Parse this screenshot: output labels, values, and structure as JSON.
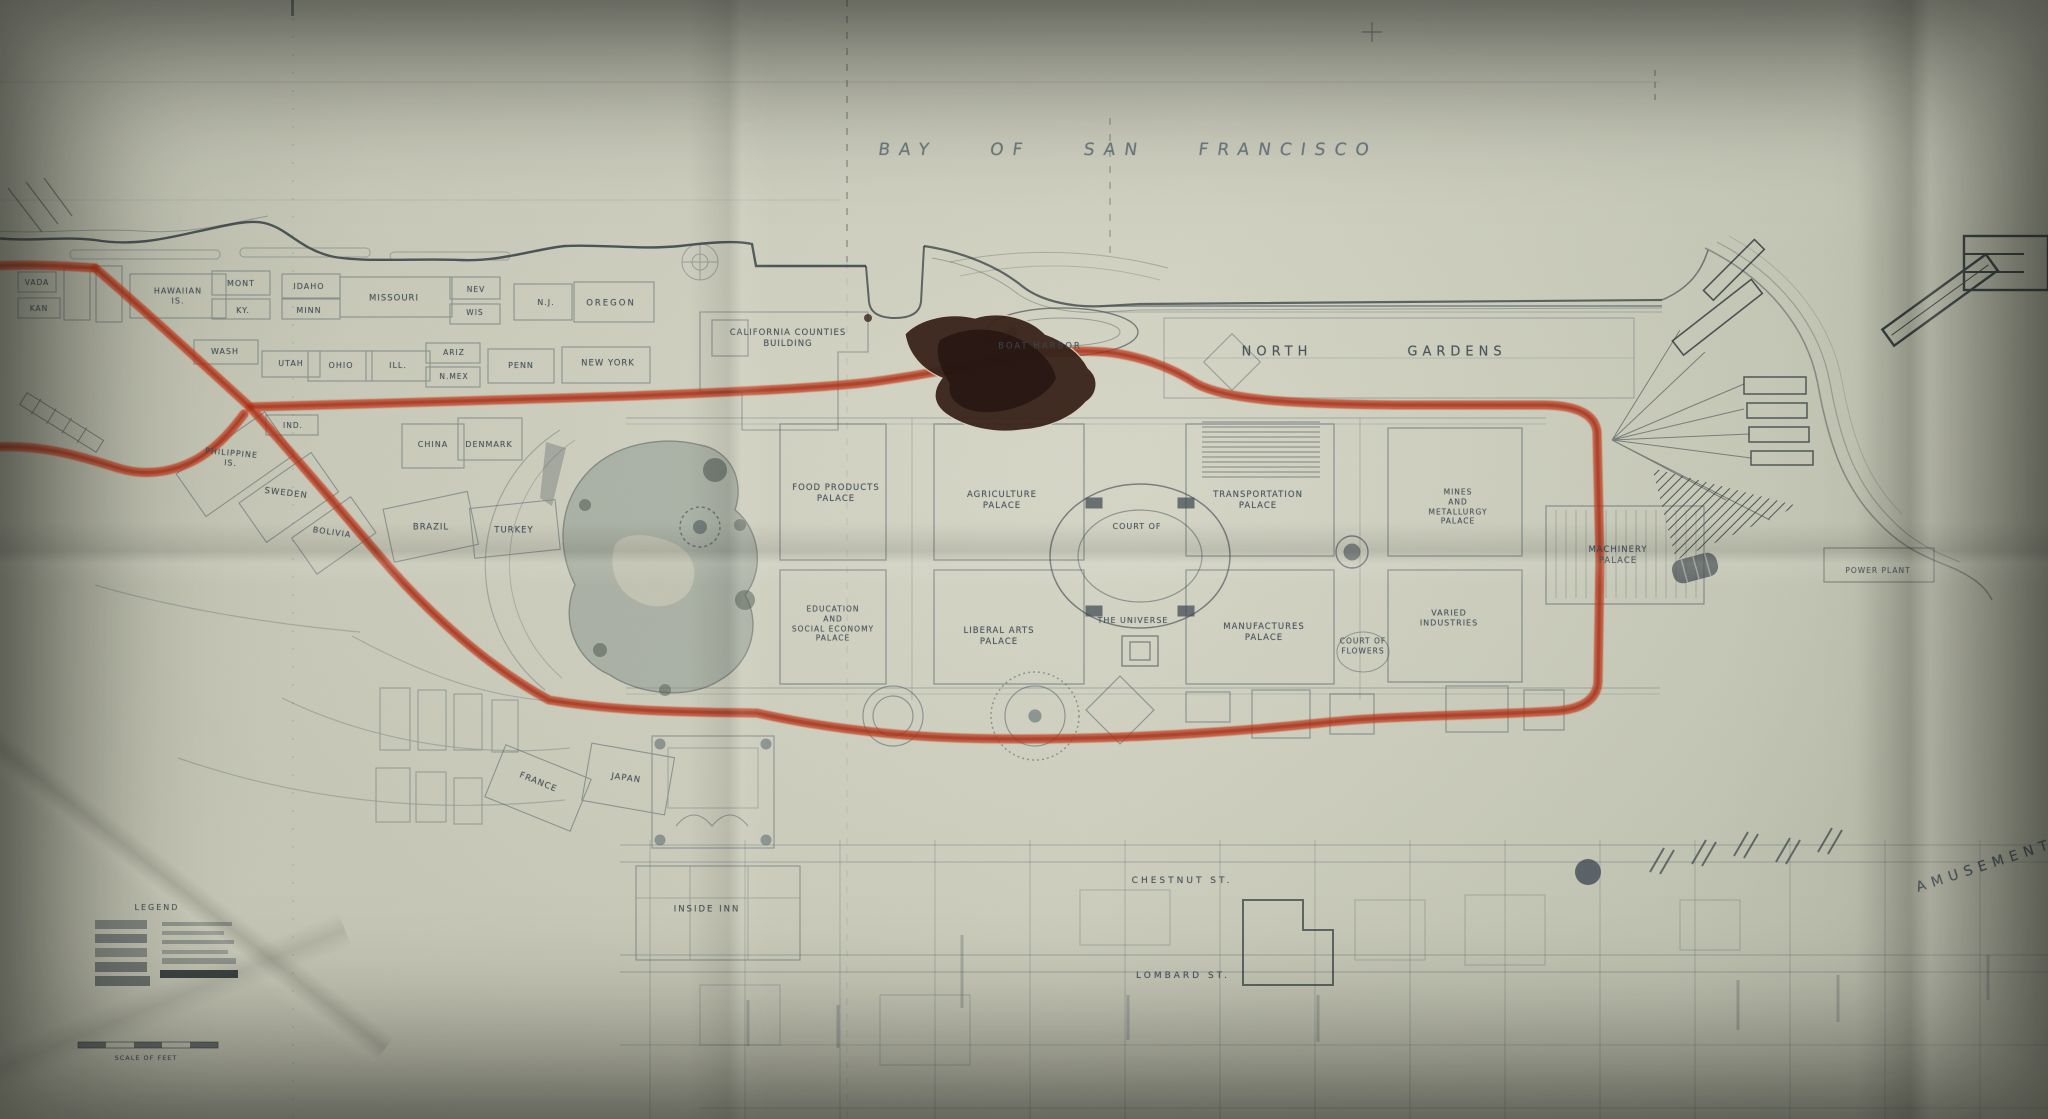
{
  "photo": {
    "bay_label": "BAY OF SAN FRANCISCO",
    "route_color": "#c23a1c",
    "route_core_color": "#8e2810",
    "legend": {
      "title": "LEGEND",
      "scale_label": "SCALE OF FEET"
    },
    "labels": [
      {
        "text": "VADA",
        "x": 37,
        "y": 283,
        "size": 7.5
      },
      {
        "text": "KAN",
        "x": 39,
        "y": 309,
        "size": 7.5
      },
      {
        "text": "HAWAIIAN\nIS.",
        "x": 178,
        "y": 297,
        "size": 8
      },
      {
        "text": "MONT",
        "x": 241,
        "y": 284,
        "size": 8
      },
      {
        "text": "KY.",
        "x": 243,
        "y": 311,
        "size": 8
      },
      {
        "text": "IDAHO",
        "x": 309,
        "y": 287,
        "size": 8
      },
      {
        "text": "MINN",
        "x": 309,
        "y": 311,
        "size": 8
      },
      {
        "text": "MISSOURI",
        "x": 394,
        "y": 299,
        "size": 8.5
      },
      {
        "text": "WASH",
        "x": 225,
        "y": 352,
        "size": 8
      },
      {
        "text": "NEV",
        "x": 476,
        "y": 290,
        "size": 7.5
      },
      {
        "text": "WIS",
        "x": 475,
        "y": 313,
        "size": 7.5
      },
      {
        "text": "N.J.",
        "x": 546,
        "y": 303,
        "size": 8
      },
      {
        "text": "OREGON",
        "x": 611,
        "y": 304,
        "size": 8.5,
        "ls": 2
      },
      {
        "text": "UTAH",
        "x": 291,
        "y": 364,
        "size": 8
      },
      {
        "text": "OHIO",
        "x": 341,
        "y": 366,
        "size": 8
      },
      {
        "text": "ILL.",
        "x": 398,
        "y": 366,
        "size": 8
      },
      {
        "text": "ARIZ",
        "x": 454,
        "y": 353,
        "size": 7.5
      },
      {
        "text": "N.MEX",
        "x": 454,
        "y": 377,
        "size": 7.5
      },
      {
        "text": "PENN",
        "x": 521,
        "y": 366,
        "size": 8
      },
      {
        "text": "NEW YORK",
        "x": 608,
        "y": 364,
        "size": 8.5
      },
      {
        "text": "IND.",
        "x": 293,
        "y": 426,
        "size": 7.5
      },
      {
        "text": "PHILIPPINE\nIS.",
        "x": 231,
        "y": 459,
        "size": 8,
        "rot": 5
      },
      {
        "text": "SWEDEN",
        "x": 286,
        "y": 494,
        "size": 8.5,
        "rot": 7
      },
      {
        "text": "BOLIVIA",
        "x": 332,
        "y": 533,
        "size": 8,
        "rot": 8
      },
      {
        "text": "BRAZIL",
        "x": 431,
        "y": 528,
        "size": 8.5
      },
      {
        "text": "TURKEY",
        "x": 514,
        "y": 531,
        "size": 8.5
      },
      {
        "text": "CHINA",
        "x": 433,
        "y": 445,
        "size": 8
      },
      {
        "text": "DENMARK",
        "x": 489,
        "y": 445,
        "size": 8
      },
      {
        "text": "FRANCE",
        "x": 538,
        "y": 783,
        "size": 8.5,
        "rot": 22
      },
      {
        "text": "JAPAN",
        "x": 626,
        "y": 779,
        "size": 8.5,
        "rot": 8
      },
      {
        "text": "INSIDE INN",
        "x": 707,
        "y": 910,
        "size": 8.5,
        "ls": 2
      },
      {
        "text": "CALIFORNIA COUNTIES\nBUILDING",
        "x": 788,
        "y": 339,
        "size": 8.5
      },
      {
        "text": "BOAT HARBOR",
        "x": 1040,
        "y": 347,
        "size": 8.5,
        "ls": 2
      },
      {
        "text": "NORTH",
        "x": 1277,
        "y": 353,
        "size": 13,
        "ls": 5
      },
      {
        "text": "GARDENS",
        "x": 1457,
        "y": 353,
        "size": 13,
        "ls": 5
      },
      {
        "text": "FOOD PRODUCTS\nPALACE",
        "x": 836,
        "y": 494,
        "size": 8.5
      },
      {
        "text": "AGRICULTURE\nPALACE",
        "x": 1002,
        "y": 501,
        "size": 8.5
      },
      {
        "text": "TRANSPORTATION\nPALACE",
        "x": 1258,
        "y": 501,
        "size": 8.5
      },
      {
        "text": "COURT OF",
        "x": 1137,
        "y": 527,
        "size": 8
      },
      {
        "text": "THE UNIVERSE",
        "x": 1133,
        "y": 621,
        "size": 8
      },
      {
        "text": "MINES\nAND\nMETALLURGY\nPALACE",
        "x": 1458,
        "y": 507,
        "size": 7.5
      },
      {
        "text": "MANUFACTURES\nPALACE",
        "x": 1264,
        "y": 633,
        "size": 8.5
      },
      {
        "text": "VARIED\nINDUSTRIES",
        "x": 1449,
        "y": 619,
        "size": 8
      },
      {
        "text": "EDUCATION\nAND\nSOCIAL ECONOMY\nPALACE",
        "x": 833,
        "y": 624,
        "size": 7.5
      },
      {
        "text": "LIBERAL ARTS\nPALACE",
        "x": 999,
        "y": 637,
        "size": 8.5
      },
      {
        "text": "COURT OF\nFLOWERS",
        "x": 1363,
        "y": 646,
        "size": 7.5
      },
      {
        "text": "MACHINERY\nPALACE",
        "x": 1618,
        "y": 556,
        "size": 8.5
      },
      {
        "text": "POWER PLANT",
        "x": 1878,
        "y": 571,
        "size": 7.5
      },
      {
        "text": "CHESTNUT ST.",
        "x": 1182,
        "y": 882,
        "size": 9,
        "ls": 3
      },
      {
        "text": "LOMBARD ST.",
        "x": 1183,
        "y": 977,
        "size": 9,
        "ls": 3
      },
      {
        "text": "AMUSEMENT",
        "x": 1985,
        "y": 866,
        "size": 14,
        "ls": 6,
        "rot": -18
      },
      {
        "text": "LEGEND",
        "x": 157,
        "y": 908,
        "size": 8,
        "ls": 2
      },
      {
        "text": "SCALE OF FEET",
        "x": 146,
        "y": 1058,
        "size": 6.5
      }
    ]
  }
}
